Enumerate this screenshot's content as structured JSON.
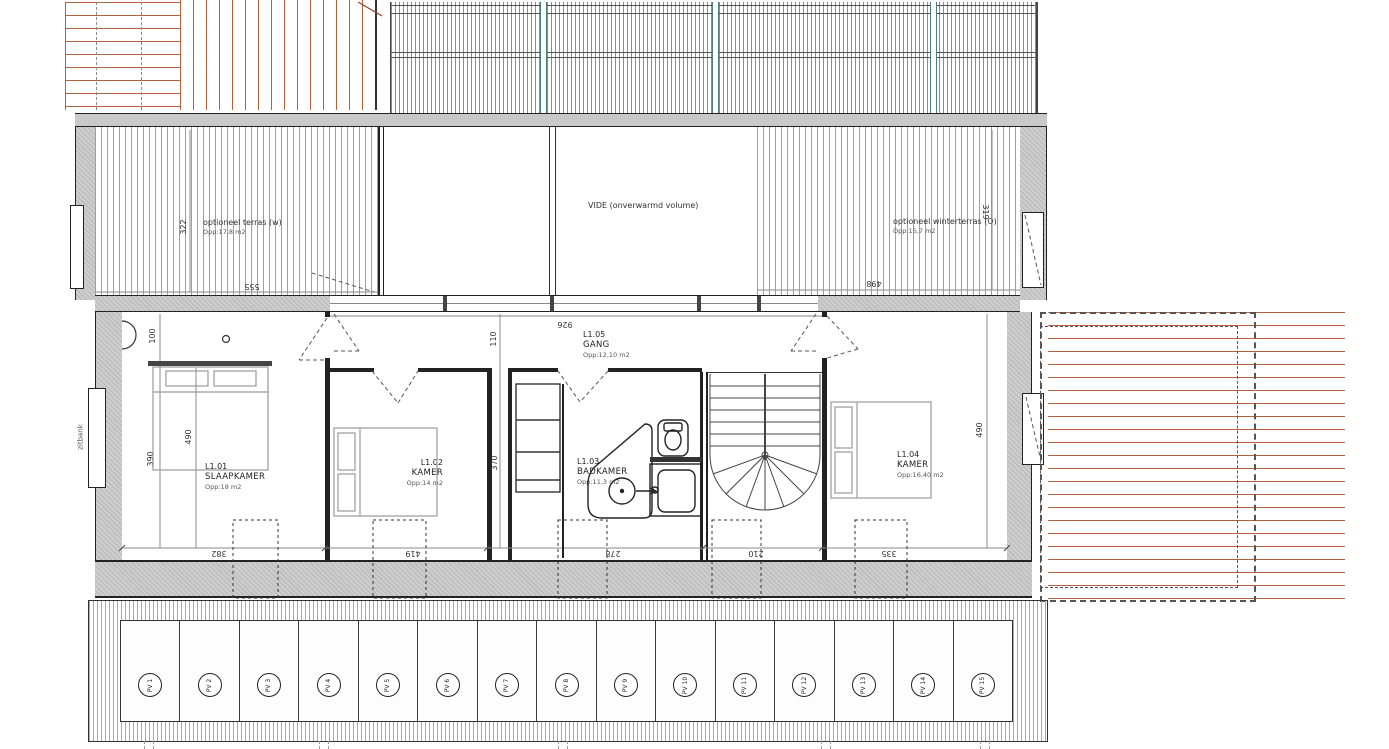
{
  "plan": {
    "upper": {
      "terrace_west": {
        "label": "optioneel terras (w)",
        "area": "Opp:17,8 m2",
        "dim_depth": "322",
        "dim_width": "555"
      },
      "vide": {
        "label": "VIDE (onverwarmd volume)"
      },
      "terrace_east": {
        "label": "optioneel winterterras (O)",
        "area": "Opp:15,7 m2",
        "dim_depth": "319",
        "dim_width": "498"
      }
    },
    "rooms": {
      "slaapkamer": {
        "id": "L1.01",
        "name": "SLAAPKAMER",
        "area": "Opp:18 m2"
      },
      "kamer2": {
        "id": "L1.02",
        "name": "KAMER",
        "area": "Opp:14 m2"
      },
      "badkamer": {
        "id": "L1.03",
        "name": "BADKAMER",
        "area": "Opp:11,3 m2"
      },
      "kamer4": {
        "id": "L1.04",
        "name": "KAMER",
        "area": "Opp:16,40 m2"
      },
      "gang": {
        "id": "L1.05",
        "name": "GANG",
        "area": "Opp:12,10 m2"
      }
    },
    "annotations": {
      "bench": "zitbank"
    },
    "dims": {
      "gang_width": "926",
      "gang_depth": "110",
      "wall_offset": "100",
      "slaapkamer_depth": "390",
      "slaapkamer_bed": "490",
      "kamer2_depth": "370",
      "kamer4_depth": "490",
      "windows": [
        "382",
        "419",
        "278",
        "210",
        "335"
      ]
    },
    "pv": {
      "items": [
        "PV 1",
        "PV 2",
        "PV 3",
        "PV 4",
        "PV 5",
        "PV 6",
        "PV 7",
        "PV 8",
        "PV 9",
        "PV 10",
        "PV 11",
        "PV 12",
        "PV 13",
        "PV 14",
        "PV 15"
      ]
    },
    "colors": {
      "deck_line": "#b4613e",
      "wall_fill": "#cfcfcf",
      "roof_post": "#4d7f7f",
      "line": "#222222"
    }
  }
}
